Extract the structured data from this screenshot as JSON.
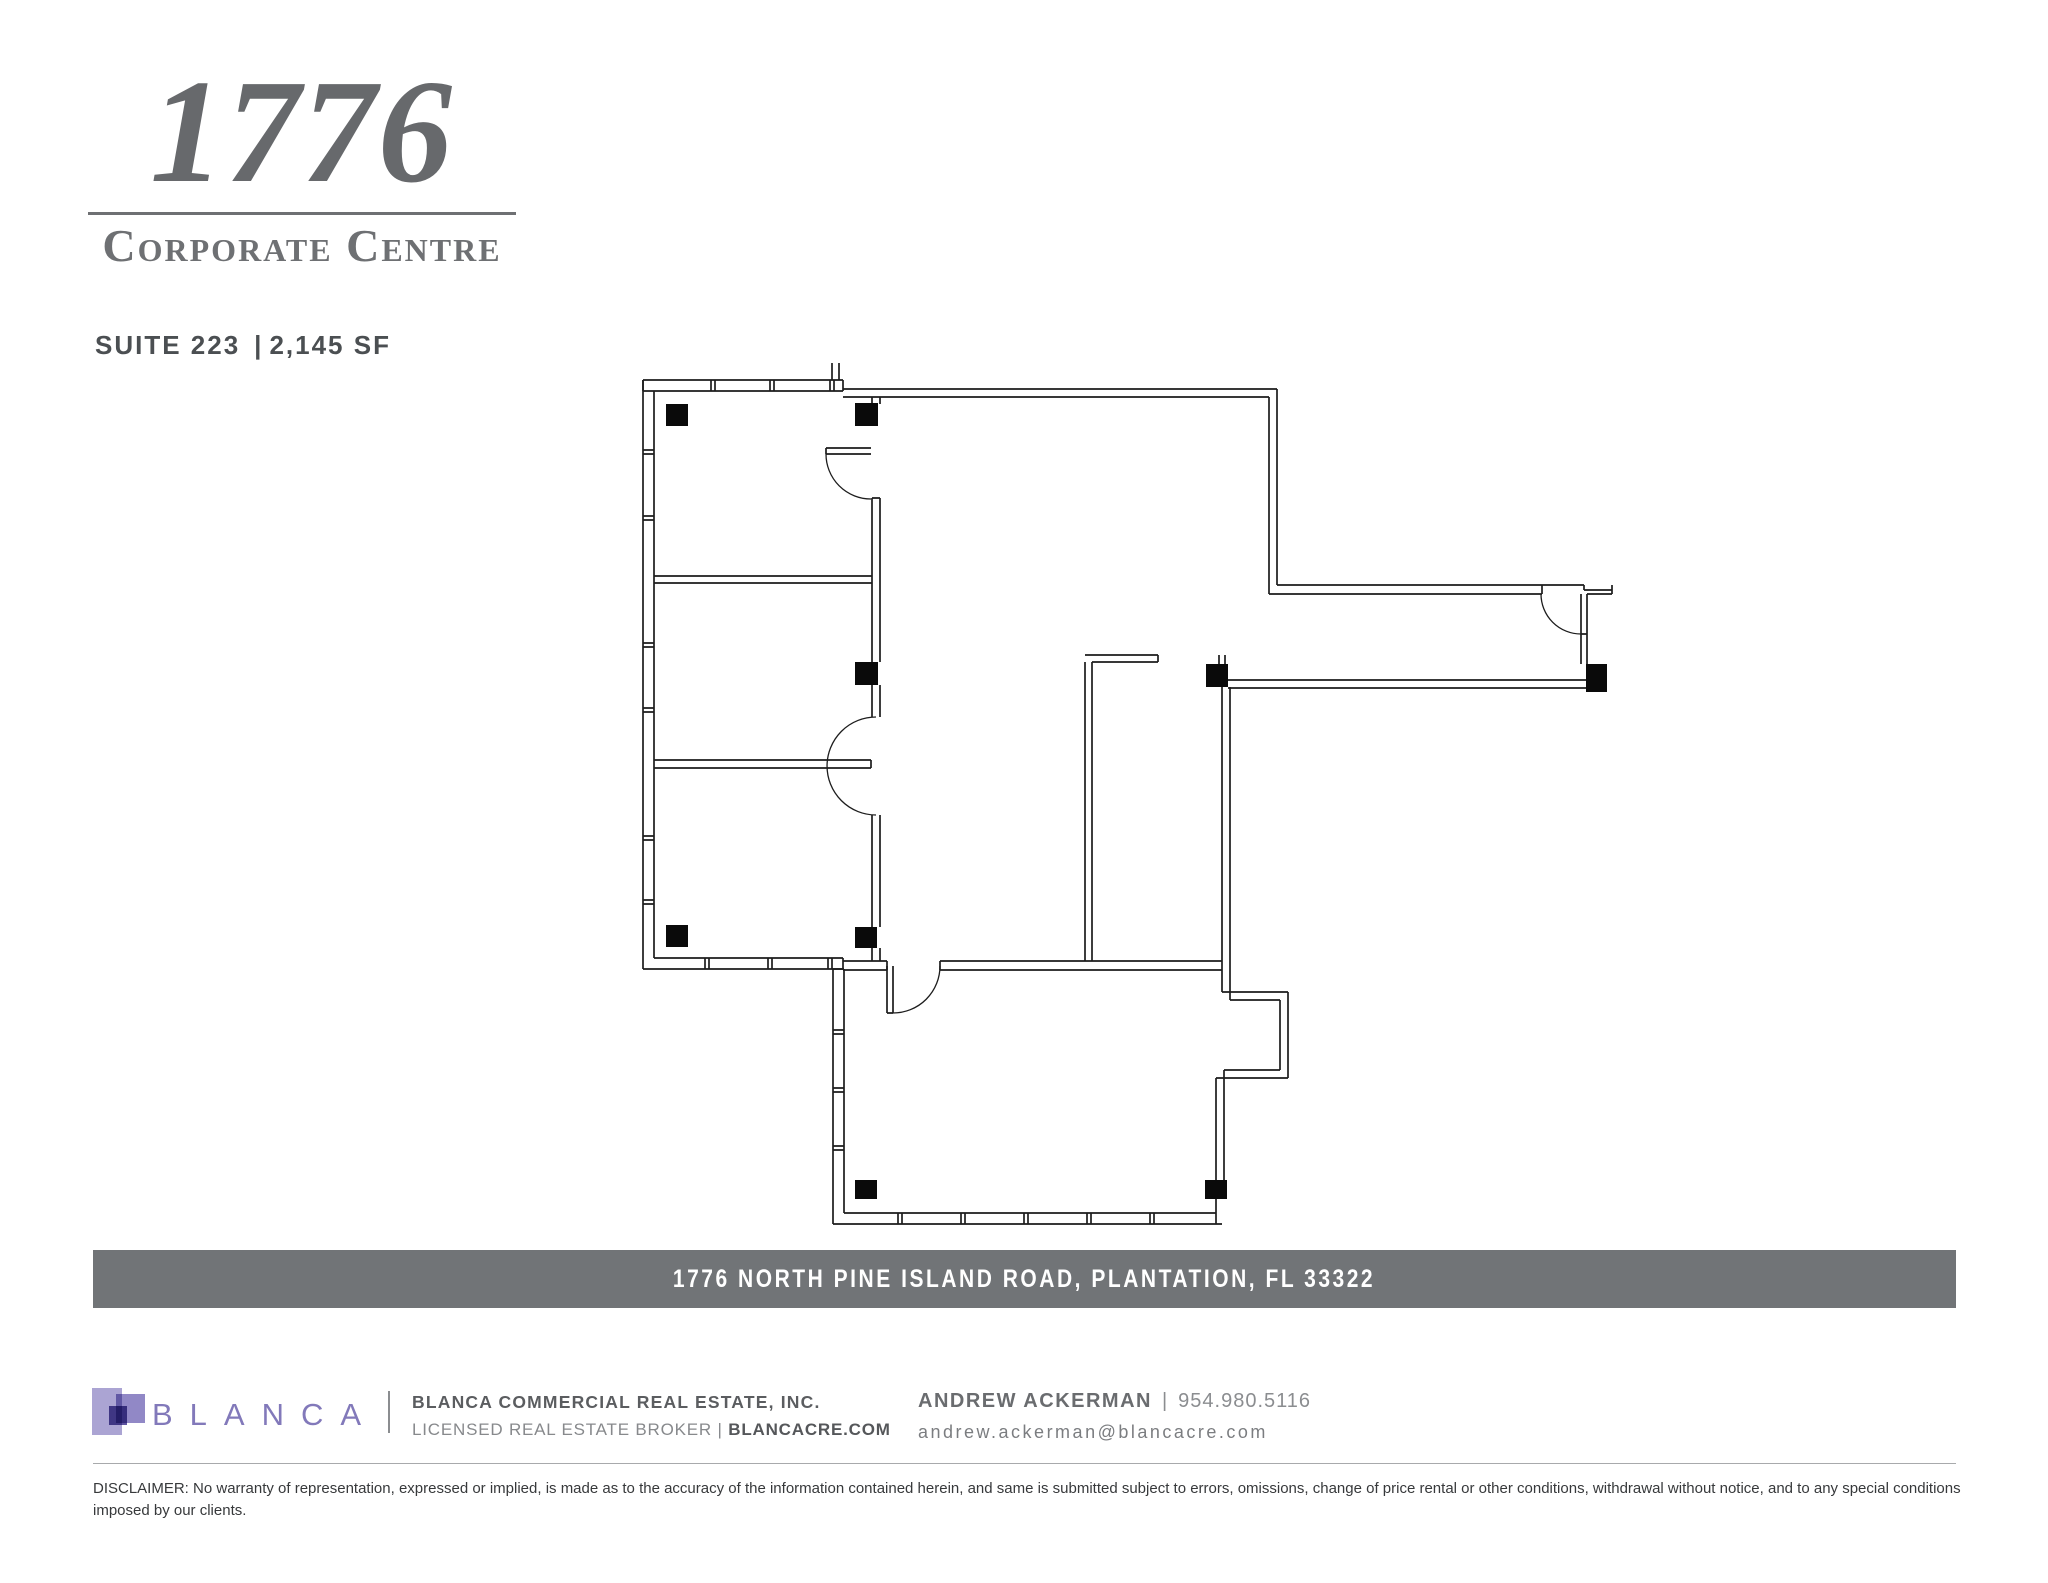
{
  "header": {
    "building_number": "1776",
    "building_name": "Corporate Centre",
    "suite_label": "SUITE 223",
    "separator": "|",
    "size_label": "2,145 SF"
  },
  "floor_plan": {
    "name": "Suite 223 floor plan",
    "wall_color": "#1d1d1d",
    "column_color": "#0a0a0a",
    "column_count": 9,
    "door_count": 4
  },
  "address_bar": {
    "text": "1776 NORTH PINE ISLAND ROAD, PLANTATION, FL 33322",
    "background": "#717477"
  },
  "footer": {
    "brand": {
      "logo_text": "BLANCA"
    },
    "company": {
      "line1": "BLANCA COMMERCIAL REAL ESTATE, INC.",
      "license": "LICENSED REAL ESTATE BROKER",
      "separator": "|",
      "website": "BLANCACRE.COM"
    },
    "agent": {
      "name": "ANDREW ACKERMAN",
      "separator": "|",
      "phone": "954.980.5116",
      "email": "andrew.ackerman@blancacre.com"
    },
    "colors": {
      "purple_light": "#aba4d3",
      "purple_mid": "#9188c6",
      "purple_dark": "#5e53a0",
      "purple_text": "#8279ba"
    }
  },
  "disclaimer": "DISCLAIMER: No warranty of representation, expressed or implied, is made as to the accuracy of the information contained herein, and same is submitted subject to errors, omissions, change of price rental or other conditions, withdrawal without notice, and to any special conditions imposed by our clients."
}
